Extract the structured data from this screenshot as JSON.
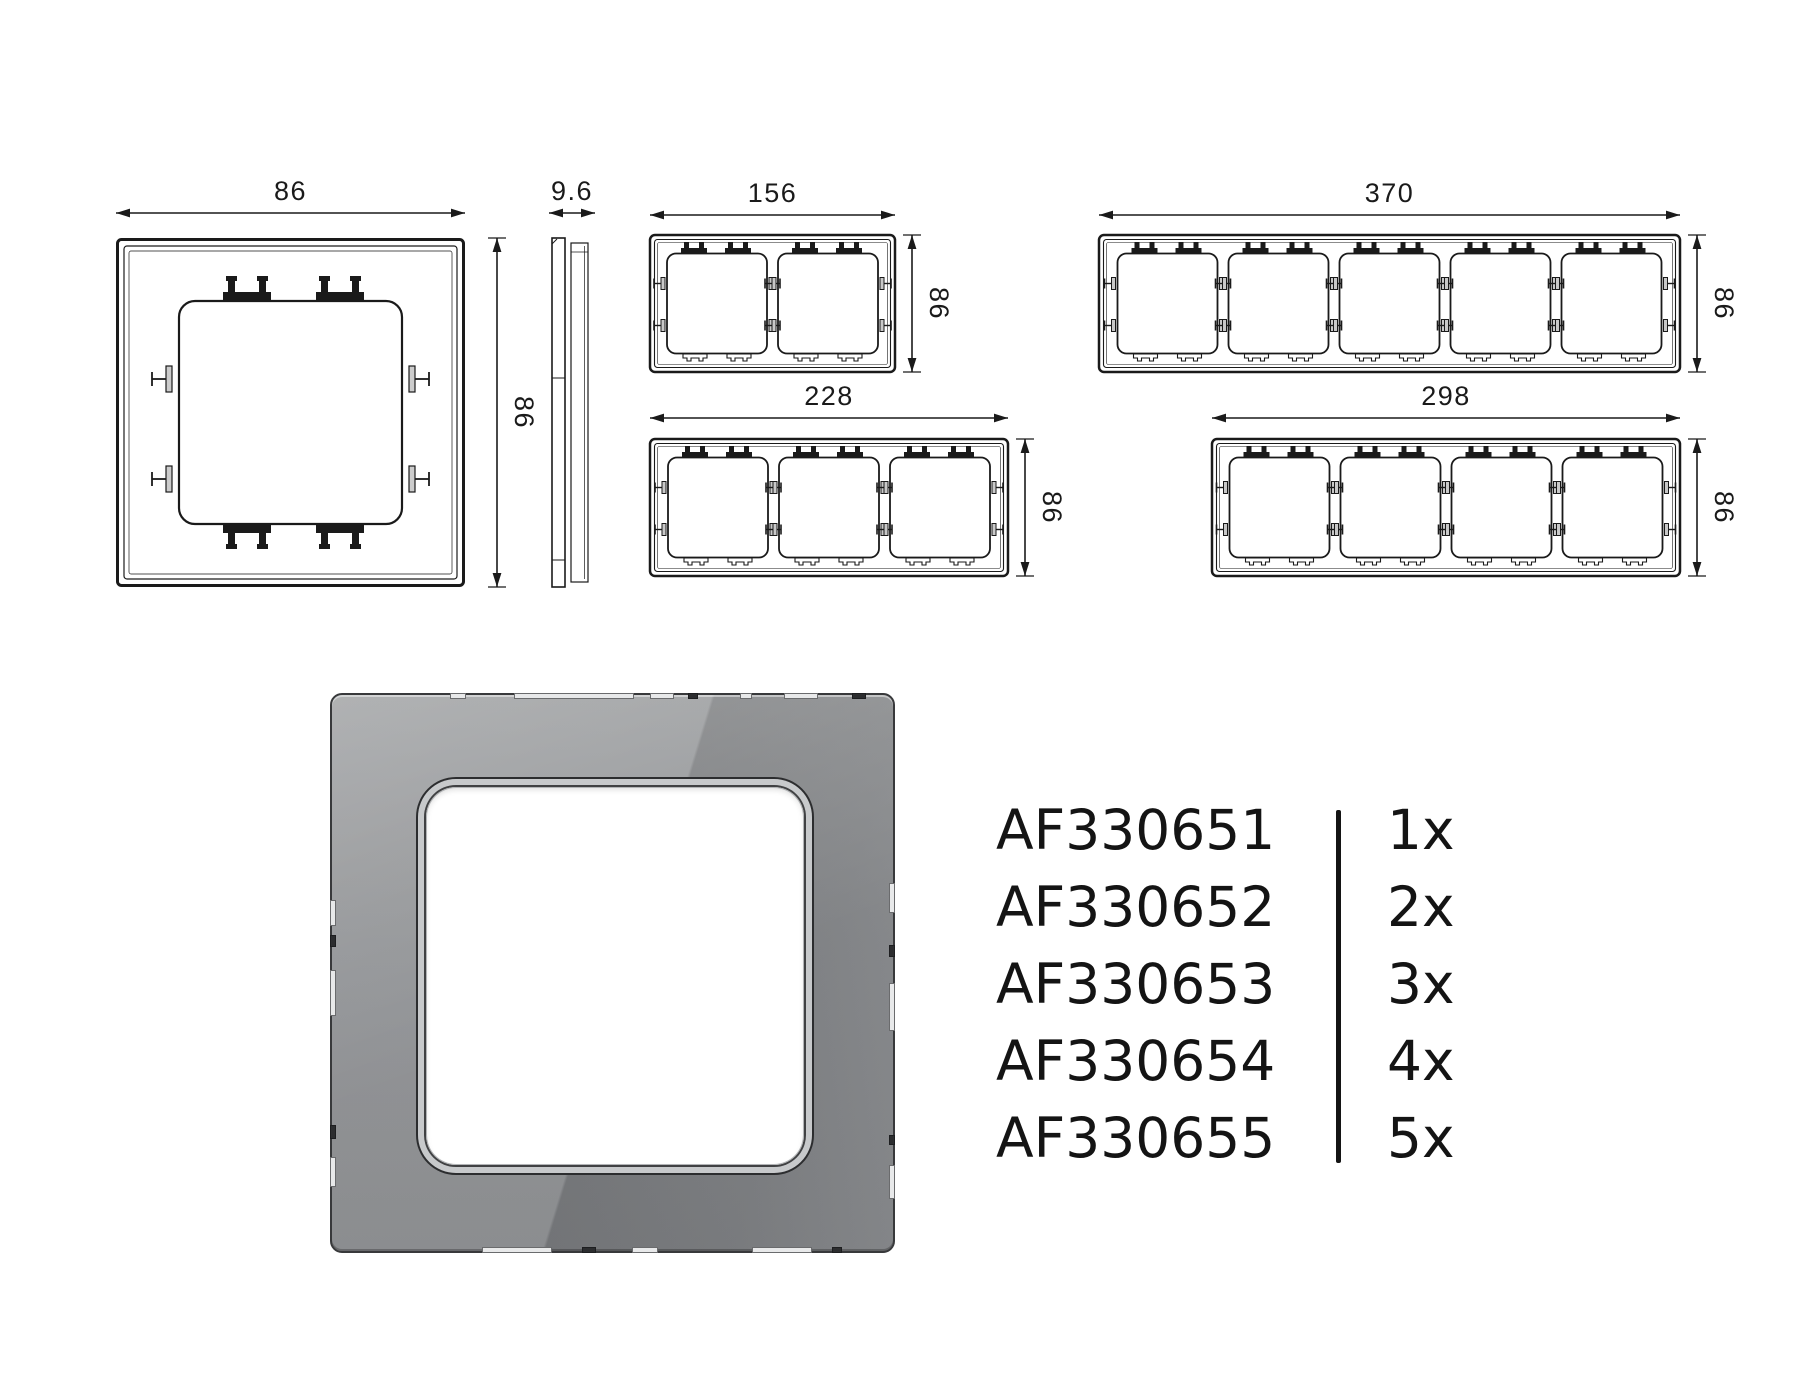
{
  "colors": {
    "line": "#1a1a1a",
    "text": "#141414",
    "render_base": "#87898c",
    "render_edge": "#38393b",
    "opening_fill": "#ffffff"
  },
  "views": {
    "front": {
      "label": "1-gang frame front view",
      "width_mm": "86",
      "height_mm": "86"
    },
    "side": {
      "label": "frame side profile",
      "depth_mm": "9.6"
    },
    "g2": {
      "label": "2-gang frame",
      "count": 2,
      "width_mm": "156",
      "height_mm": "86"
    },
    "g5": {
      "label": "5-gang frame",
      "count": 5,
      "width_mm": "370",
      "height_mm": "86"
    },
    "g3": {
      "label": "3-gang frame",
      "count": 3,
      "width_mm": "228",
      "height_mm": "86"
    },
    "g4": {
      "label": "4-gang frame",
      "count": 4,
      "width_mm": "298",
      "height_mm": "86"
    }
  },
  "render": {
    "label": "grey glass 1-gang frame 3D render"
  },
  "product_list": {
    "rows": [
      {
        "code": "AF330651",
        "qty": "1x"
      },
      {
        "code": "AF330652",
        "qty": "2x"
      },
      {
        "code": "AF330653",
        "qty": "3x"
      },
      {
        "code": "AF330654",
        "qty": "4x"
      },
      {
        "code": "AF330655",
        "qty": "5x"
      }
    ]
  }
}
